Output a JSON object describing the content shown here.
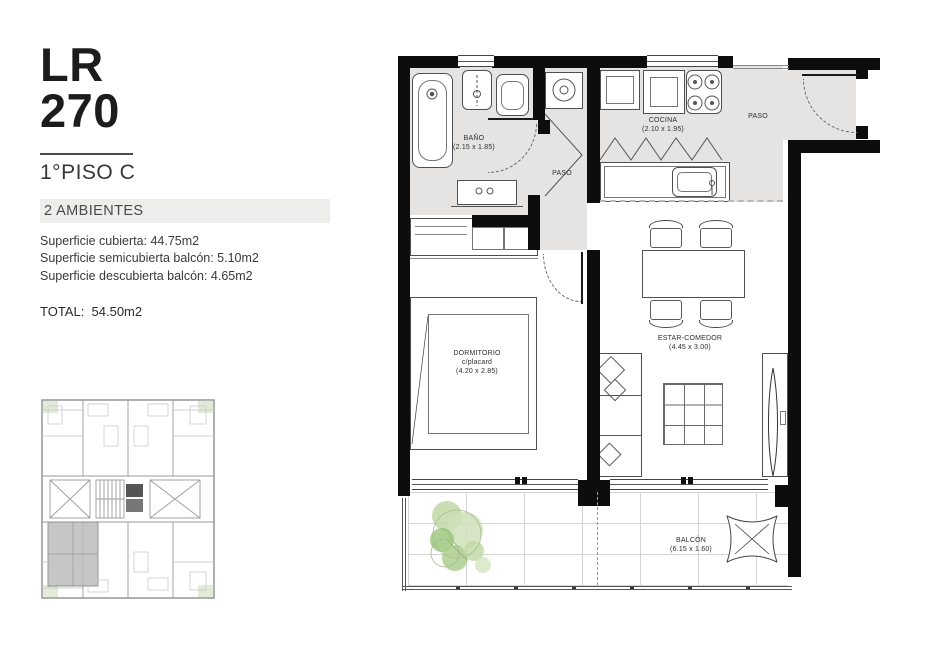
{
  "panel": {
    "code_line1": "LR",
    "code_line2": "270",
    "floor": "1°PISO C",
    "type_badge": "2 AMBIENTES",
    "areas": [
      "Superficie cubierta: 44.75m2",
      "Superficie semicubierta balcón: 5.10m2",
      "Superficie descubierta balcón: 4.65m2"
    ],
    "total": "TOTAL:  54.50m2"
  },
  "plan": {
    "bano": {
      "name": "BAÑO",
      "dim": "(2.15 x 1.85)"
    },
    "cocina": {
      "name": "COCINA",
      "dim": "(2.10 x 1.95)"
    },
    "paso_center": "PASO",
    "paso_entry": "PASO",
    "dormitorio": {
      "name": "DORMITORIO",
      "sub": "c/placard",
      "dim": "(4.20 x 2.85)"
    },
    "estar": {
      "name": "ESTAR-COMEDOR",
      "dim": "(4.45 x 3.00)"
    },
    "balcon": {
      "name": "BALCÓN",
      "dim": "(6.15 x 1.60)"
    }
  },
  "colors": {
    "wall": "#0d0d0d",
    "floor_gray": "#e5e4e2",
    "badge_bg": "#ededeb",
    "keyplan_highlight": "#bcbcbc",
    "plant_green": "#a9cc88"
  }
}
